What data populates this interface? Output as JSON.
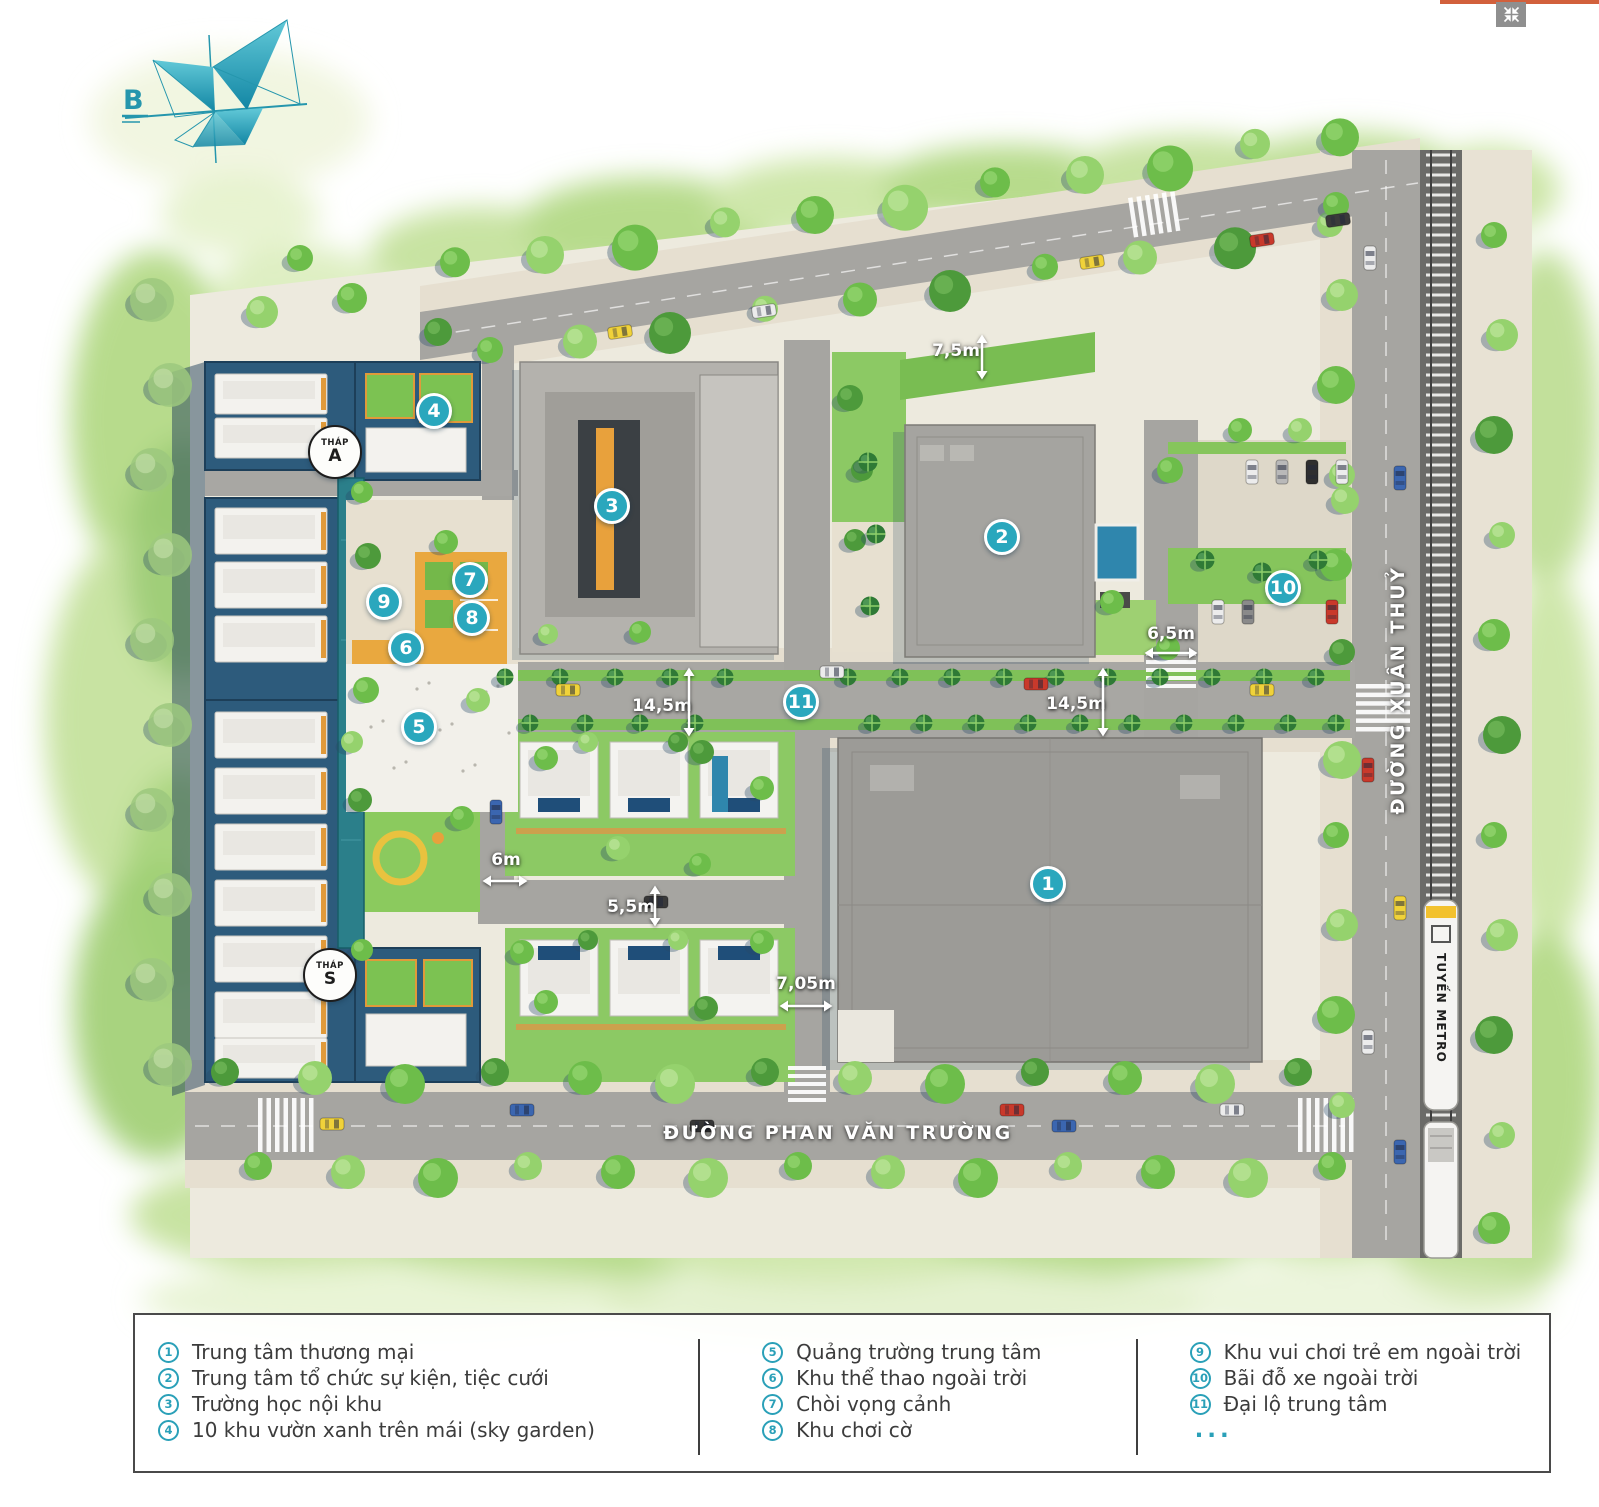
{
  "viewer": {
    "accent_color": "#d2603c",
    "fullscreen_button": {
      "icon": "compress-icon"
    }
  },
  "compass": {
    "label": "B"
  },
  "map": {
    "street_right": "ĐƯỜNG XUÂN THUỶ",
    "street_bottom": "ĐƯỜNG PHAN VĂN TRƯỜNG",
    "metro_label": "TUYẾN METRO",
    "towers": [
      {
        "name": "THÁP",
        "letter": "A",
        "x": 335,
        "y": 452
      },
      {
        "name": "THÁP",
        "letter": "S",
        "x": 330,
        "y": 975
      }
    ],
    "markers": [
      {
        "n": "1",
        "x": 1048,
        "y": 884
      },
      {
        "n": "2",
        "x": 1002,
        "y": 537
      },
      {
        "n": "3",
        "x": 612,
        "y": 506
      },
      {
        "n": "4",
        "x": 434,
        "y": 411
      },
      {
        "n": "5",
        "x": 419,
        "y": 727
      },
      {
        "n": "6",
        "x": 406,
        "y": 648
      },
      {
        "n": "7",
        "x": 470,
        "y": 580
      },
      {
        "n": "8",
        "x": 472,
        "y": 618
      },
      {
        "n": "9",
        "x": 384,
        "y": 602
      },
      {
        "n": "10",
        "x": 1283,
        "y": 588
      },
      {
        "n": "11",
        "x": 801,
        "y": 702
      }
    ],
    "dimensions": [
      {
        "text": "7,5m",
        "x": 956,
        "y": 351,
        "arrow": "v",
        "ax": 982,
        "ay": 357,
        "len": 46
      },
      {
        "text": "6,5m",
        "x": 1171,
        "y": 634,
        "arrow": "h",
        "ax": 1171,
        "ay": 653,
        "len": 54
      },
      {
        "text": "14,5m",
        "x": 662,
        "y": 706,
        "arrow": "v",
        "ax": 689,
        "ay": 702,
        "len": 70
      },
      {
        "text": "14,5m",
        "x": 1076,
        "y": 704,
        "arrow": "v",
        "ax": 1103,
        "ay": 702,
        "len": 70
      },
      {
        "text": "6m",
        "x": 506,
        "y": 860,
        "arrow": "h",
        "ax": 505,
        "ay": 881,
        "len": 46
      },
      {
        "text": "5,5m",
        "x": 631,
        "y": 907,
        "arrow": "v",
        "ax": 655,
        "ay": 906,
        "len": 42
      },
      {
        "text": "7,05m",
        "x": 806,
        "y": 984,
        "arrow": "h",
        "ax": 806,
        "ay": 1006,
        "len": 54
      }
    ]
  },
  "legend": {
    "columns": [
      {
        "items": [
          {
            "n": "1",
            "label": "Trung tâm thương mại"
          },
          {
            "n": "2",
            "label": "Trung tâm tổ chức sự kiện, tiệc cưới"
          },
          {
            "n": "3",
            "label": "Trường học nội khu"
          },
          {
            "n": "4",
            "label": "10 khu vườn xanh trên mái (sky garden)"
          }
        ]
      },
      {
        "items": [
          {
            "n": "5",
            "label": "Quảng trường trung tâm"
          },
          {
            "n": "6",
            "label": "Khu thể thao ngoài trời"
          },
          {
            "n": "7",
            "label": "Chòi vọng cảnh"
          },
          {
            "n": "8",
            "label": "Khu chơi cờ"
          }
        ]
      },
      {
        "items": [
          {
            "n": "9",
            "label": "Khu vui chơi trẻ em ngoài trời"
          },
          {
            "n": "10",
            "label": "Bãi đỗ xe ngoài trời"
          },
          {
            "n": "11",
            "label": "Đại lộ trung tâm"
          }
        ],
        "more": "..."
      }
    ]
  },
  "colors": {
    "marker_teal": "#2aa7bd",
    "legend_teal": "#2aa0b8",
    "accent_orange": "#d2603c",
    "road_gray": "#a6a5a1",
    "tower_navy": "#2d5b7c",
    "lawn_green": "#8cc964",
    "pool_blue": "#2f86ad"
  }
}
